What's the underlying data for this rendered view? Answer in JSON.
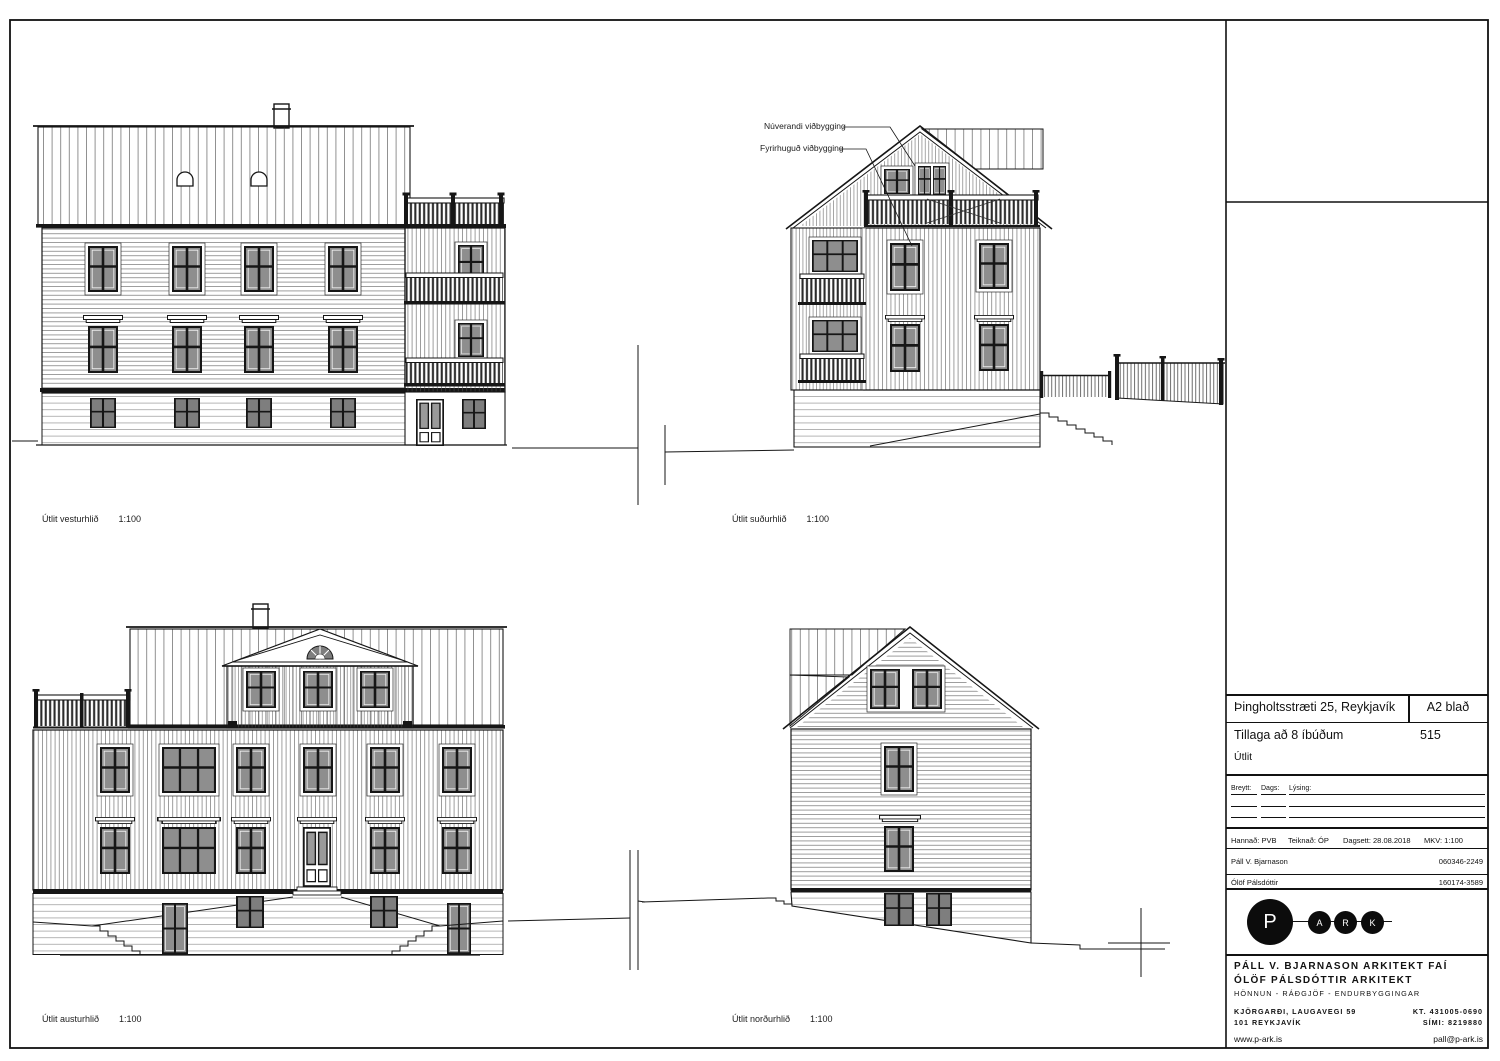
{
  "sheet": {
    "labels": {
      "west": {
        "name": "Útlit vesturhlið",
        "scale": "1:100"
      },
      "south": {
        "name": "Útlit suðurhlið",
        "scale": "1:100"
      },
      "east": {
        "name": "Útlit austurhlið",
        "scale": "1:100"
      },
      "north": {
        "name": "Útlit norðurhlið",
        "scale": "1:100"
      }
    },
    "annotations": {
      "existing": "Núverandi viðbygging",
      "proposed": "Fyrirhuguð viðbygging"
    }
  },
  "titleblock": {
    "project_title": "Þingholtsstræti 25, Reykjavík",
    "sheet_size": "A2 blað",
    "subtitle": "Tillaga að 8 íbúðum",
    "sheet_number": "515",
    "content": "Útlit",
    "rev_headers": {
      "changed": "Breytt:",
      "date": "Dags:",
      "desc": "Lýsing:"
    },
    "meta": {
      "designed": "Hannað: PVB",
      "drawn": "Teiknað: ÓP",
      "dated": "Dagsett: 28.08.2018",
      "scale": "MKV: 1:100"
    },
    "people": [
      {
        "name": "Páll V. Bjarnason",
        "id": "060346-2249"
      },
      {
        "name": "Ólöf Pálsdóttir",
        "id": "160174-3589"
      }
    ],
    "logo": {
      "p": "P",
      "a": "A",
      "r": "R",
      "k": "K"
    },
    "firm": {
      "line1": "PÁLL V. BJARNASON ARKITEKT FAÍ",
      "line2": "ÓLÖF PÁLSDÓTTIR ARKITEKT",
      "line3": "HÖNNUN - RÁÐGJÖF - ENDURBYGGINGAR"
    },
    "address": {
      "l1": "KJÖRGARÐI, LAUGAVEGI 59",
      "l2": "101 REYKJAVÍK",
      "kt": "KT. 431005-0690",
      "phone": "SÍMI: 8219880"
    },
    "web": {
      "site": "www.p-ark.is",
      "email": "pall@p-ark.is"
    },
    "colors": {
      "ink": "#161616",
      "glass": "#8e8e8e"
    }
  }
}
